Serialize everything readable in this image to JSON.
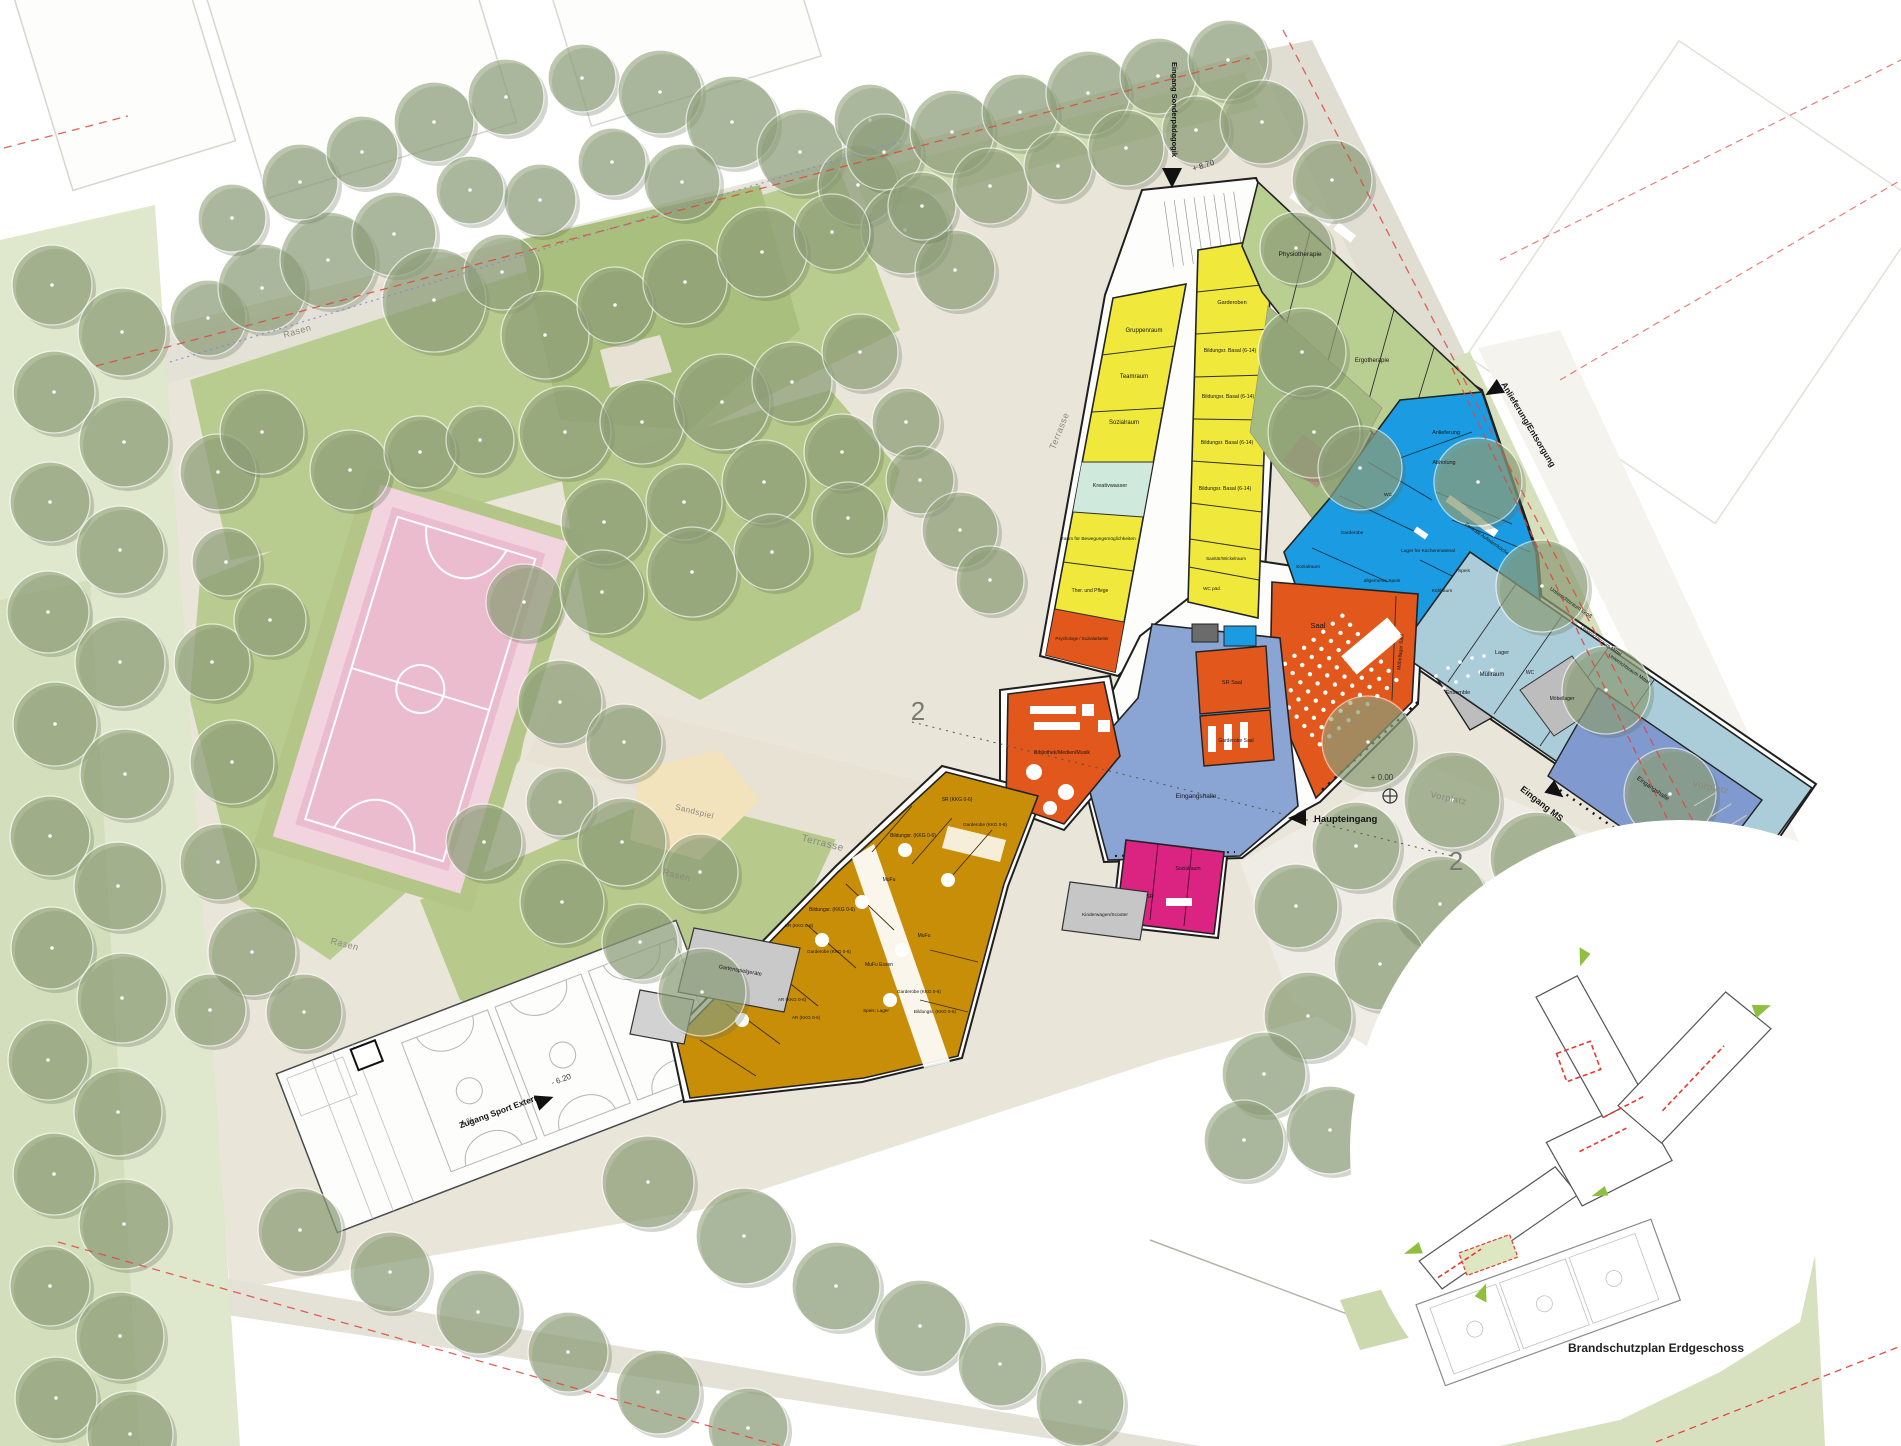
{
  "inset": {
    "caption": "Brandschutzplan Erdgeschoss"
  },
  "site": {
    "terrasse": "Terrasse",
    "rasen": "Rasen",
    "sandspiel": "Sandspiel",
    "vorplatz": "Vorplatz",
    "haupteingang": "Haupteingang",
    "eingang_ms": "Eingang MS",
    "eingang_sp": "Eingang Sonderpädagogik",
    "zugang_sport": "Zugang Sport Extern",
    "anlieferung_street": "Anlieferung/Entsorgung",
    "level_top": "+ 8.70",
    "level_zero": "+ 0.00",
    "level_sport": "- 6.20",
    "slope": "4 %",
    "section": "2"
  },
  "rooms": {
    "gruppenraum": "Gruppenraum",
    "teamraum": "Teamraum",
    "sozialraum": "Sozialraum",
    "kreativwasser": "Kreativwasser",
    "bewegung": "Raum für Bewegungsmöglichkeiten",
    "pflege": "Ther. und Pflege",
    "psychologe": "Psychologe / Sozialarbeiter",
    "garderoben": "Garderoben",
    "bildung_basal": "Bildungsr. Basal (6-14)",
    "sanitaer": "Sanitär/Wickelraum",
    "wc_paed": "WC päd.",
    "physiotherapie": "Physiotherapie",
    "ergotherapie": "Ergotherapie",
    "anlieferung": "Anlieferung",
    "abholung": "Abholung",
    "aufwaermkueche": "Zentrale Aufwärmküche",
    "lager_kueche": "Lager für Küchenmaterial",
    "allg_speis": "allgemeine Speis",
    "kuehlraum": "Kühlraum",
    "speis": "Speis",
    "garderobe": "Garderobe",
    "wc": "WC",
    "muellraum": "Müllraum",
    "saal": "Saal",
    "moebellager_saal": "Möbellager Saal",
    "sr_saal": "SR Saal",
    "garderobe_saal": "Garderobe Saal",
    "bibliothek": "Bibliothek/Medien/Musik",
    "eingangshalle": "Eingangshalle",
    "ensemble": "Ensemble",
    "lager": "Lager",
    "unterricht_gross": "Unterrichtsraum Groß",
    "unterricht_mittel": "Unterrichtsraum Mittel",
    "moebellager": "Möbellager",
    "sr_kkg": "SR (KKG 0-6)",
    "garderobe_kkg": "Garderobe (KKG 0-6)",
    "bildung_kkg": "Bildungsr. (KKG 0-6)",
    "mufu": "MuFu",
    "mufu_essen": "MuFu Essen",
    "ar_kkg": "AR (KKG 0-6)",
    "speis_lager": "Speis; Lager",
    "sr": "SR",
    "kinderwagen": "Kinderwagen/Scooter",
    "gartenspiel": "Gartenspielgeräte"
  },
  "colors": {
    "kindergarten_ochre": "#c98e08",
    "sonderpaedagogik_yellow": "#f0e83a",
    "kueche_blau": "#1b9ce2",
    "musik_hellblau": "#aacdd9",
    "saal_orange": "#e2571b",
    "eingang_blau": "#8aa4d4",
    "hort_magenta": "#db2382",
    "therapie_gruen": "#b9cf92",
    "nebenraum_grau": "#bdbdbd",
    "sportfeld_rosa": "#eabccd",
    "boundary_rot": "#e0483f"
  }
}
